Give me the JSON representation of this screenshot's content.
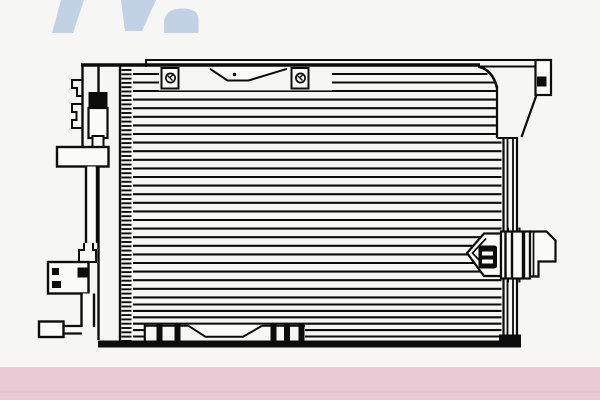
{
  "meta": {
    "description": "Black-and-white technical line drawing of an automotive air-conditioning condenser (radiator-style core) shown front-on, catalog product image",
    "canvas": {
      "width": 600,
      "height": 400
    }
  },
  "colors": {
    "background": "#f6f6f4",
    "line": "#0c0c0c",
    "fill": "#fbfbfa",
    "watermark_blue": "#c1d2e4",
    "footer_pink": "#e9cad5",
    "footer_pink_shade": "#ddbac8"
  },
  "watermark": {
    "stroke_count": 3,
    "position": "top-left",
    "style": "partial italic logo letters, cropped by top edge"
  },
  "footer_bar": {
    "visible": true,
    "y_top": 367,
    "height": 33
  },
  "parts": [
    {
      "name": "condenser-core",
      "detail": "horizontal tube/fin lines"
    },
    {
      "name": "top-mounting-bar",
      "detail": "two screw tabs and center clip"
    },
    {
      "name": "top-right-bracket",
      "detail": "square mounting hole"
    },
    {
      "name": "right-side-channel"
    },
    {
      "name": "right-fitting-block",
      "detail": "pointed boss with dark bolt"
    },
    {
      "name": "receiver-drier-assembly",
      "detail": "left side: drier, brackets, pipes"
    },
    {
      "name": "bottom-mounting-bar",
      "detail": "feet with slots and center clip"
    }
  ],
  "drawing": {
    "tubes": {
      "x_left": 133,
      "zones": [
        {
          "start": 91,
          "end": 298,
          "step": 8.6
        },
        {
          "start": 304.5,
          "end": 337,
          "step": 6.4
        }
      ],
      "partials": [
        74,
        82.5
      ],
      "corner": {
        "x_flat": 478,
        "k": 0.95,
        "y0": 64,
        "mid_end": 497,
        "low_end": 501.5,
        "y_mid": 86,
        "y_low": 138
      },
      "width": 2.1
    },
    "ticks": {
      "x1": 121.5,
      "x2": 131.5,
      "start": 70,
      "end": 341,
      "step": 4.3,
      "width": 1.9
    },
    "channel": {
      "xs": [
        503.5,
        507.5,
        513,
        517
      ],
      "widths": [
        2.2,
        1.8,
        1.8,
        2.2
      ],
      "y1": 138,
      "y2": 341
    },
    "bottom_stripes": {
      "xs": [
        156.5,
        174.5,
        270.5,
        284,
        298.5
      ],
      "w": 6,
      "y": 324.5,
      "h": 17.5
    }
  }
}
